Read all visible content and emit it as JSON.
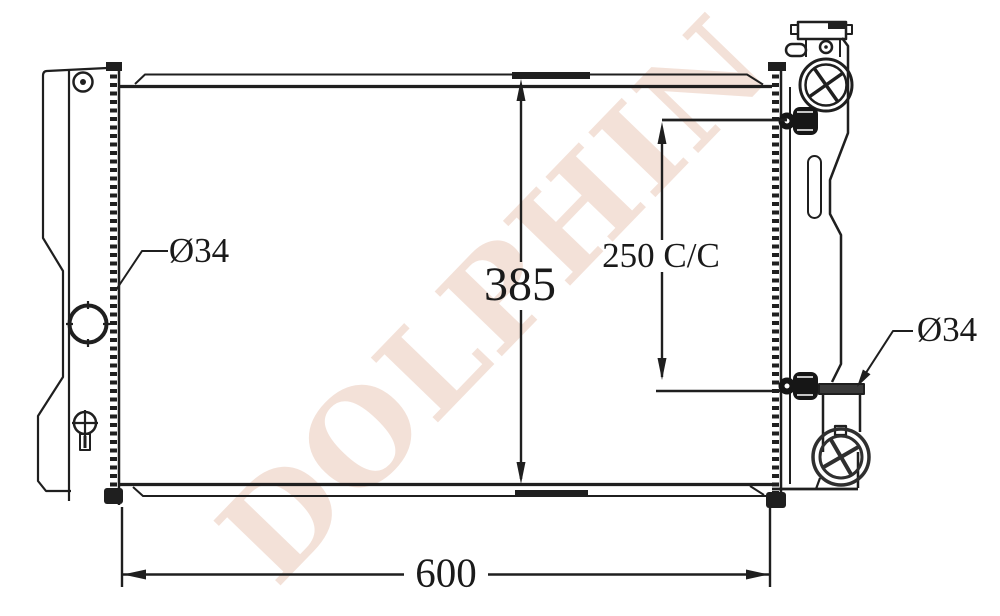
{
  "drawing": {
    "subject": "radiator-technical-drawing"
  },
  "watermark": {
    "text": "DOLPHIN",
    "color": "#f3e1d8"
  },
  "dimensions": {
    "core_height": "385",
    "port_spacing": "250 C/C",
    "overall_width": "600",
    "left_pipe_diameter": "Ø34",
    "right_pipe_diameter": "Ø34"
  },
  "colors": {
    "line": "#1f1f1f",
    "background": "#ffffff"
  }
}
